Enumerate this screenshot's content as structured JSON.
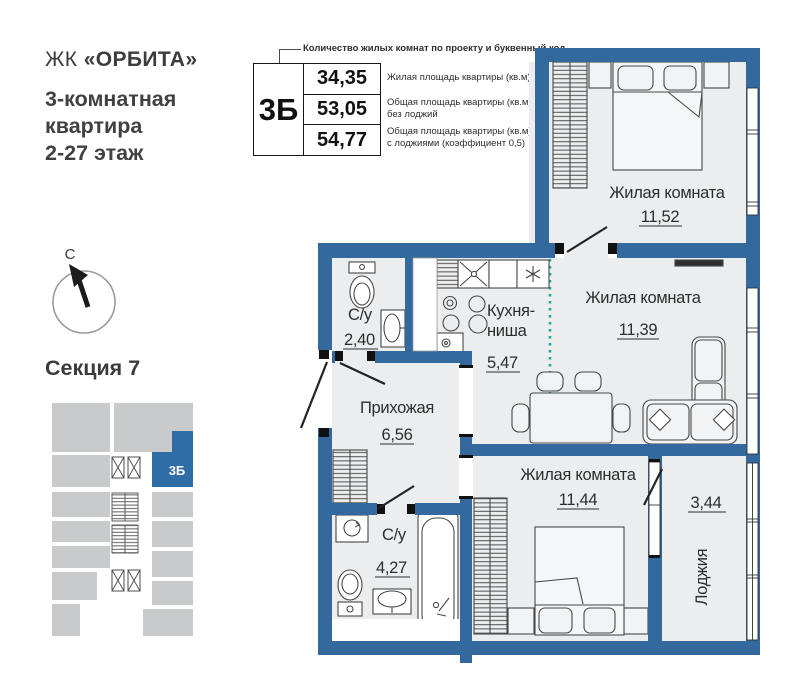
{
  "header": {
    "brand_prefix": "ЖК",
    "brand_name": "«ОРБИТА»",
    "subtitle_lines": [
      "3-комнатная",
      "квартира",
      "2-27 этаж"
    ]
  },
  "legend": {
    "callout": "Количество жилых комнат по проекту и буквенный код",
    "code": "3Б",
    "rows": [
      {
        "value": "34,35",
        "desc1": "Жилая площадь квартиры (кв.м)",
        "desc2": ""
      },
      {
        "value": "53,05",
        "desc1": "Общая площадь квартиры (кв.м)",
        "desc2": "без лоджий"
      },
      {
        "value": "54,77",
        "desc1": "Общая площадь квартиры (кв.м)",
        "desc2": "с лоджиями (коэффициент 0,5)"
      }
    ]
  },
  "compass": {
    "north": "С"
  },
  "section": {
    "title": "Секция 7",
    "code": "3Б"
  },
  "plan": {
    "living1": {
      "name": "Жилая комната",
      "area": "11,52"
    },
    "living2": {
      "name": "Жилая комната",
      "area": "11,39"
    },
    "living3": {
      "name": "Жилая комната",
      "area": "11,44"
    },
    "kitchen": {
      "name_line1": "Кухня-",
      "name_line2": "ниша",
      "area": "5,47"
    },
    "bath1": {
      "name": "С/у",
      "area": "2,40"
    },
    "bath2": {
      "name": "С/у",
      "area": "4,27"
    },
    "hall": {
      "name": "Прихожая",
      "area": "6,56"
    },
    "loggia": {
      "name": "Лоджия",
      "area": "3,44"
    }
  },
  "colors": {
    "wall_blue": "#33699d",
    "accent_blue": "#2e6da6",
    "floor": "#ebedee",
    "kitchen_zone_teal": "#1aa6a6",
    "minimap_gray": "#c9cacc"
  }
}
